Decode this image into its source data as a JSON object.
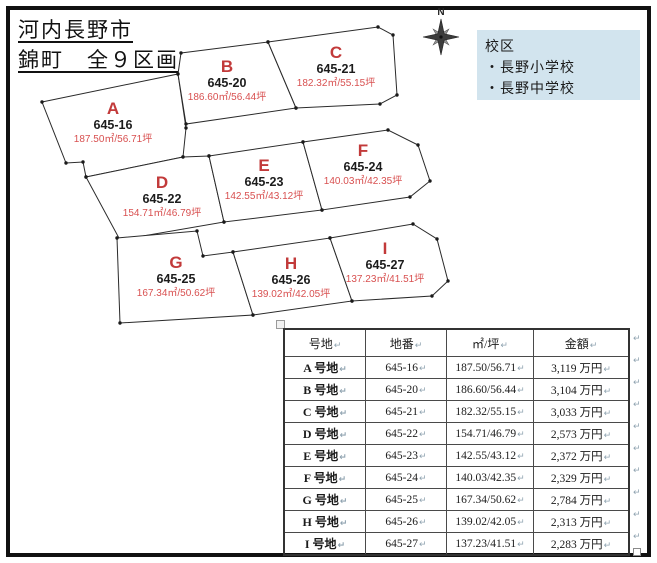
{
  "page": {
    "title_line1": "河内長野市",
    "title_line2": "錦町　全９区画"
  },
  "compass": {
    "label": "N"
  },
  "school_box": {
    "title": "校区",
    "items": [
      "・長野小学校",
      "・長野中学校"
    ],
    "bg_color": "#d2e4ee"
  },
  "map": {
    "line_color": "#2a2a2a",
    "letter_color": "#c23a3a",
    "lot_color": "#1c1c1c",
    "area_color": "#d85050",
    "plots": [
      {
        "letter": "A",
        "lot": "645-16",
        "area": "187.50㎡/56.71坪",
        "points": "42,102 178,74 186,128 183,157 86,177 83,162 66,163",
        "cx": 113,
        "cy": 123
      },
      {
        "letter": "B",
        "lot": "645-20",
        "area": "186.60㎡/56.44坪",
        "points": "181,53 268,42 296,108 186,124 178,74",
        "cx": 227,
        "cy": 81
      },
      {
        "letter": "C",
        "lot": "645-21",
        "area": "182.32㎡/55.15坪",
        "points": "268,42 378,27 393,35 397,95 380,104 296,108",
        "cx": 336,
        "cy": 67
      },
      {
        "letter": "D",
        "lot": "645-22",
        "area": "154.71㎡/46.79坪",
        "points": "86,177 183,157 209,156 224,222 120,240",
        "cx": 162,
        "cy": 197
      },
      {
        "letter": "E",
        "lot": "645-23",
        "area": "142.55㎡/43.12坪",
        "points": "209,156 303,142 322,210 224,222",
        "cx": 264,
        "cy": 180
      },
      {
        "letter": "F",
        "lot": "645-24",
        "area": "140.03㎡/42.35坪",
        "points": "303,142 388,130 418,145 430,181 410,197 322,210",
        "cx": 363,
        "cy": 165
      },
      {
        "letter": "G",
        "lot": "645-25",
        "area": "167.34㎡/50.62坪",
        "points": "117,238 197,231 203,256 233,252 253,315 120,323",
        "cx": 176,
        "cy": 277
      },
      {
        "letter": "H",
        "lot": "645-26",
        "area": "139.02㎡/42.05坪",
        "points": "233,252 330,238 352,301 253,315",
        "cx": 291,
        "cy": 278
      },
      {
        "letter": "I",
        "lot": "645-27",
        "area": "137.23㎡/41.51坪",
        "points": "330,238 413,224 437,239 448,281 432,296 352,301",
        "cx": 385,
        "cy": 263
      }
    ]
  },
  "table": {
    "headers": [
      "号地",
      "地番",
      "㎡/坪",
      "金額"
    ],
    "rows": [
      [
        "A 号地",
        "645-16",
        "187.50/56.71",
        "3,119 万円"
      ],
      [
        "B 号地",
        "645-20",
        "186.60/56.44",
        "3,104 万円"
      ],
      [
        "C 号地",
        "645-21",
        "182.32/55.15",
        "3,033 万円"
      ],
      [
        "D 号地",
        "645-22",
        "154.71/46.79",
        "2,573 万円"
      ],
      [
        "E 号地",
        "645-23",
        "142.55/43.12",
        "2,372 万円"
      ],
      [
        "F 号地",
        "645-24",
        "140.03/42.35",
        "2,329 万円"
      ],
      [
        "G 号地",
        "645-25",
        "167.34/50.62",
        "2,784 万円"
      ],
      [
        "H 号地",
        "645-26",
        "139.02/42.05",
        "2,313 万円"
      ],
      [
        "I 号地",
        "645-27",
        "137.23/41.51",
        "2,283 万円"
      ]
    ],
    "return_mark": "↵"
  }
}
